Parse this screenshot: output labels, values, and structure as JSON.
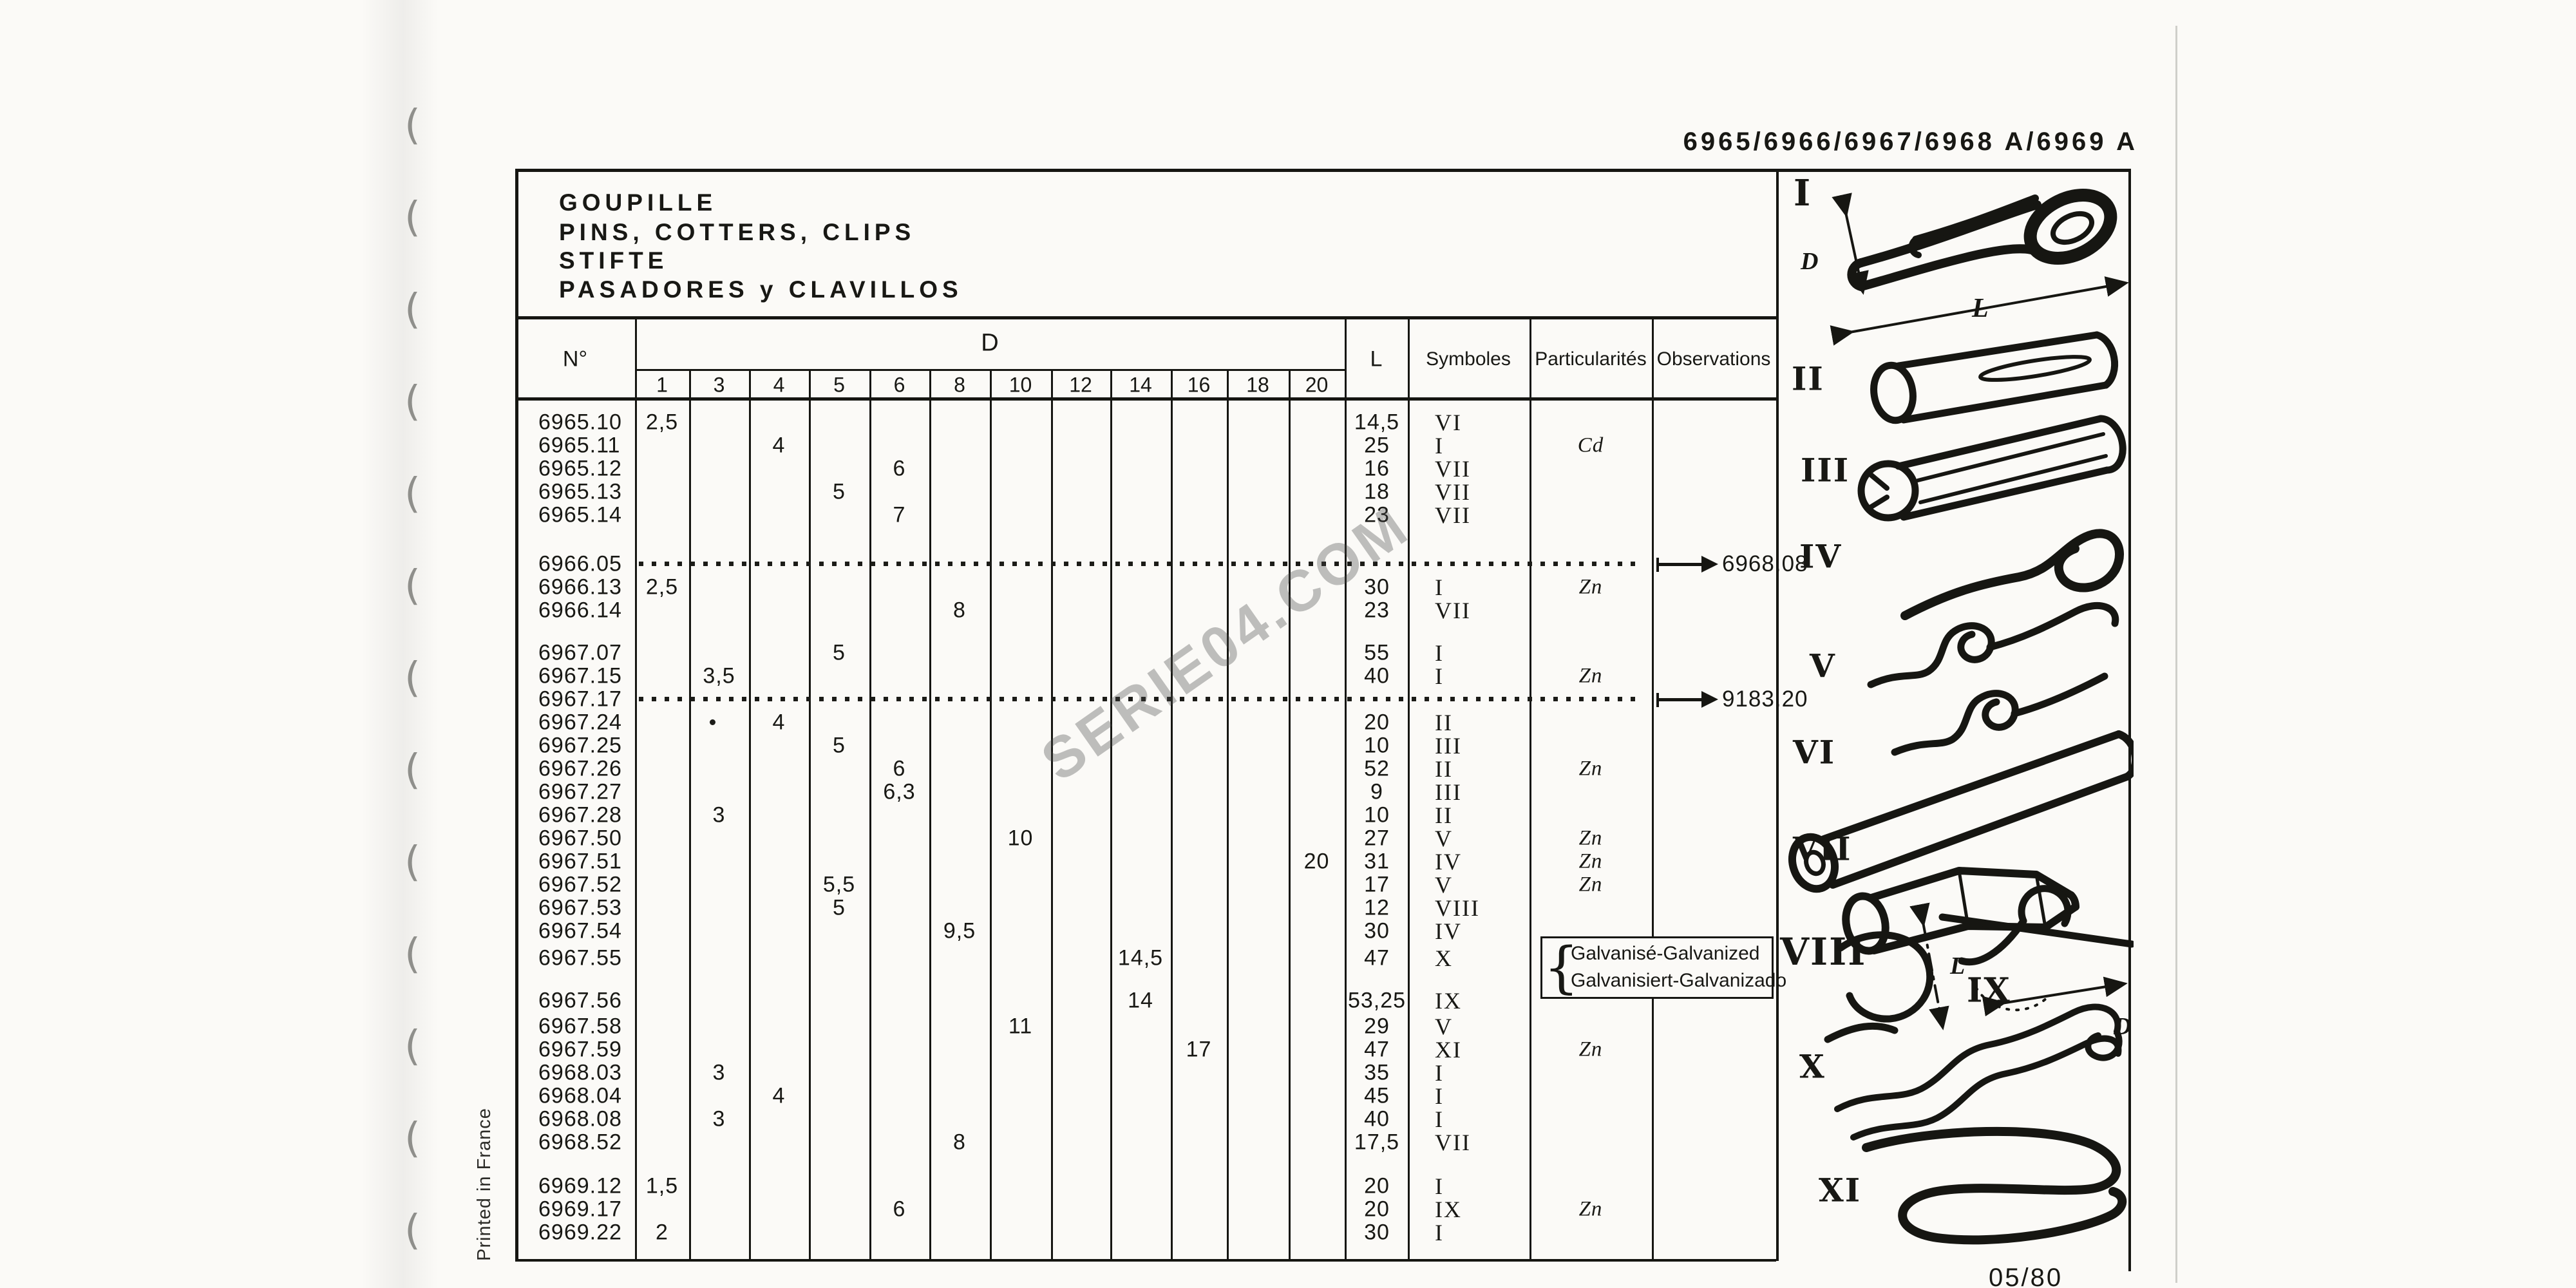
{
  "page": {
    "header_code": "6965/6966/6967/6968 A/6969 A",
    "page_code": "05/80",
    "printed_in": "Printed in France",
    "watermark": "SERIE04.COM"
  },
  "title": {
    "line1": "GOUPILLE",
    "line2": "PINS, COTTERS, CLIPS",
    "line3": "STIFTE",
    "line4": "PASADORES y CLAVILLOS"
  },
  "table": {
    "headers": {
      "no": "N°",
      "d": "D",
      "l": "L",
      "symboles": "Symboles",
      "particularites": "Particularités",
      "observations": "Observations"
    },
    "d_sizes": [
      "1",
      "3",
      "4",
      "5",
      "6",
      "8",
      "10",
      "12",
      "14",
      "16",
      "18",
      "20"
    ],
    "note": {
      "line1": "Galvanisé-Galvanized",
      "line2": "Galvanisiert-Galvanizado"
    },
    "rows": [
      {
        "no": "6965.10",
        "ds": "1",
        "d": "2,5",
        "l": "14,5",
        "sym": "VI"
      },
      {
        "no": "6965.11",
        "ds": "4",
        "d": "4",
        "l": "25",
        "sym": "I",
        "part": "Cd"
      },
      {
        "no": "6965.12",
        "ds": "6",
        "d": "6",
        "l": "16",
        "sym": "VII"
      },
      {
        "no": "6965.13",
        "ds": "5",
        "d": "5",
        "l": "18",
        "sym": "VII"
      },
      {
        "no": "6965.14",
        "ds": "6",
        "d": "7",
        "l": "23",
        "sym": "VII"
      },
      {
        "no": "6966.05",
        "dotted": true,
        "arrow": "6968.08",
        "gap": 1.1
      },
      {
        "no": "6966.13",
        "ds": "1",
        "d": "2,5",
        "l": "30",
        "sym": "I",
        "part": "Zn"
      },
      {
        "no": "6966.14",
        "ds": "8",
        "d": "8",
        "l": "23",
        "sym": "VII"
      },
      {
        "no": "6967.07",
        "ds": "5",
        "d": "5",
        "l": "55",
        "sym": "I",
        "gap": 0.85
      },
      {
        "no": "6967.15",
        "ds": "3",
        "d": "3,5",
        "l": "40",
        "sym": "I",
        "part": "Zn"
      },
      {
        "no": "6967.17",
        "dotted": true,
        "arrow": "9183.20"
      },
      {
        "no": "6967.24",
        "ds": "4",
        "d": "4",
        "l": "20",
        "sym": "II",
        "dot3": true
      },
      {
        "no": "6967.25",
        "ds": "5",
        "d": "5",
        "l": "10",
        "sym": "III"
      },
      {
        "no": "6967.26",
        "ds": "6",
        "d": "6",
        "l": "52",
        "sym": "II",
        "part": "Zn"
      },
      {
        "no": "6967.27",
        "ds": "6",
        "d": "6,3",
        "l": "9",
        "sym": "III"
      },
      {
        "no": "6967.28",
        "ds": "3",
        "d": "3",
        "l": "10",
        "sym": "II"
      },
      {
        "no": "6967.50",
        "ds": "10",
        "d": "10",
        "l": "27",
        "sym": "V",
        "part": "Zn"
      },
      {
        "no": "6967.51",
        "ds": "20",
        "d": "20",
        "l": "31",
        "sym": "IV",
        "part": "Zn"
      },
      {
        "no": "6967.52",
        "ds": "5",
        "d": "5,5",
        "l": "17",
        "sym": "V",
        "part": "Zn"
      },
      {
        "no": "6967.53",
        "ds": "5",
        "d": "5",
        "l": "12",
        "sym": "VIII"
      },
      {
        "no": "6967.54",
        "ds": "8",
        "d": "9,5",
        "l": "30",
        "sym": "IV"
      },
      {
        "no": "6967.55",
        "ds": "14",
        "d": "14,5",
        "l": "47",
        "sym": "X",
        "note": true,
        "gap": 0.15
      },
      {
        "no": "6967.56",
        "ds": "14",
        "d": "14",
        "l": "53,25",
        "sym": "IX",
        "gap": 0.85
      },
      {
        "no": "6967.58",
        "ds": "10",
        "d": "11",
        "l": "29",
        "sym": "V",
        "gap": 0.1
      },
      {
        "no": "6967.59",
        "ds": "16",
        "d": "17",
        "l": "47",
        "sym": "XI",
        "part": "Zn"
      },
      {
        "no": "6968.03",
        "ds": "3",
        "d": "3",
        "l": "35",
        "sym": "I"
      },
      {
        "no": "6968.04",
        "ds": "4",
        "d": "4",
        "l": "45",
        "sym": "I"
      },
      {
        "no": "6968.08",
        "ds": "3",
        "d": "3",
        "l": "40",
        "sym": "I"
      },
      {
        "no": "6968.52",
        "ds": "8",
        "d": "8",
        "l": "17,5",
        "sym": "VII"
      },
      {
        "no": "6969.12",
        "ds": "1",
        "d": "1,5",
        "l": "20",
        "sym": "I",
        "gap": 0.9
      },
      {
        "no": "6969.17",
        "ds": "6",
        "d": "6",
        "l": "20",
        "sym": "IX",
        "part": "Zn"
      },
      {
        "no": "6969.22",
        "ds": "1",
        "d": "2",
        "l": "30",
        "sym": "I"
      }
    ]
  },
  "figures": [
    {
      "numeral": "I",
      "name": "cotter-pin"
    },
    {
      "numeral": "II",
      "name": "slotted-pin"
    },
    {
      "numeral": "III",
      "name": "grooved-pin"
    },
    {
      "numeral": "IV",
      "name": "hook-clip"
    },
    {
      "numeral": "V",
      "name": "double-wave-clip"
    },
    {
      "numeral": "VI",
      "name": "tube-pin"
    },
    {
      "numeral": "VII",
      "name": "barrel-pin"
    },
    {
      "numeral": "VIII",
      "name": "c-clip"
    },
    {
      "numeral": "IX",
      "name": "r-clip"
    },
    {
      "numeral": "X",
      "name": "wave-wire-clip"
    },
    {
      "numeral": "XI",
      "name": "large-wire-clip"
    }
  ],
  "figure_dims": {
    "d": "D",
    "l": "L"
  }
}
